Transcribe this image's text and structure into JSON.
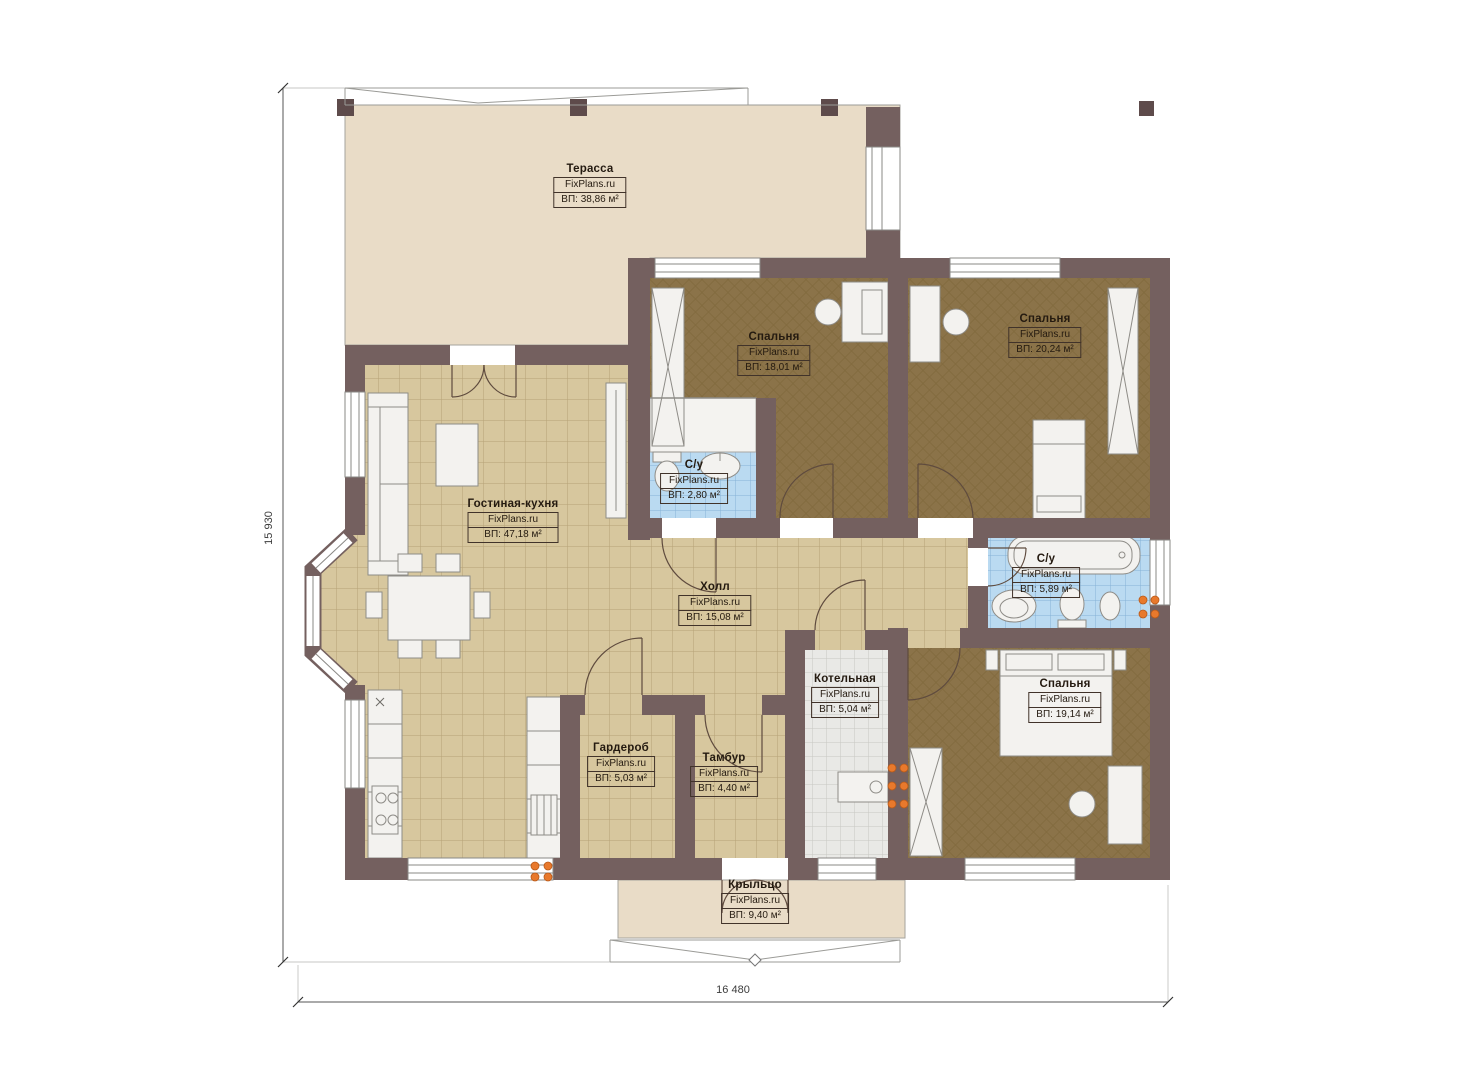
{
  "plan": {
    "brand": "FixPlans.ru",
    "rooms": [
      {
        "name": "Терасса",
        "area": "ВП: 38,86 м²"
      },
      {
        "name": "Спальня",
        "area": "ВП: 18,01 м²"
      },
      {
        "name": "Спальня",
        "area": "ВП: 20,24 м²"
      },
      {
        "name": "С/у",
        "area": "ВП: 2,80 м²"
      },
      {
        "name": "Гостиная-кухня",
        "area": "ВП: 47,18 м²"
      },
      {
        "name": "Холл",
        "area": "ВП: 15,08 м²"
      },
      {
        "name": "С/у",
        "area": "ВП: 5,89 м²"
      },
      {
        "name": "Котельная",
        "area": "ВП: 5,04 м²"
      },
      {
        "name": "Гардероб",
        "area": "ВП: 5,03 м²"
      },
      {
        "name": "Тамбур",
        "area": "ВП: 4,40 м²"
      },
      {
        "name": "Спальня",
        "area": "ВП: 19,14 м²"
      },
      {
        "name": "Крыльцо",
        "area": "ВП: 9,40 м²"
      }
    ],
    "dimensions": {
      "height_left": "15 930",
      "width_bottom": "16 480"
    },
    "colors": {
      "wall": "#74605f",
      "post": "#5e4b4b",
      "terrace": "#e9dcc7",
      "tile_beige": "#d7c79e",
      "carpet": "#8b7349",
      "tile_blue": "#badaf1",
      "tile_gray": "#e9e9e6",
      "heater": "#e8792c"
    }
  }
}
